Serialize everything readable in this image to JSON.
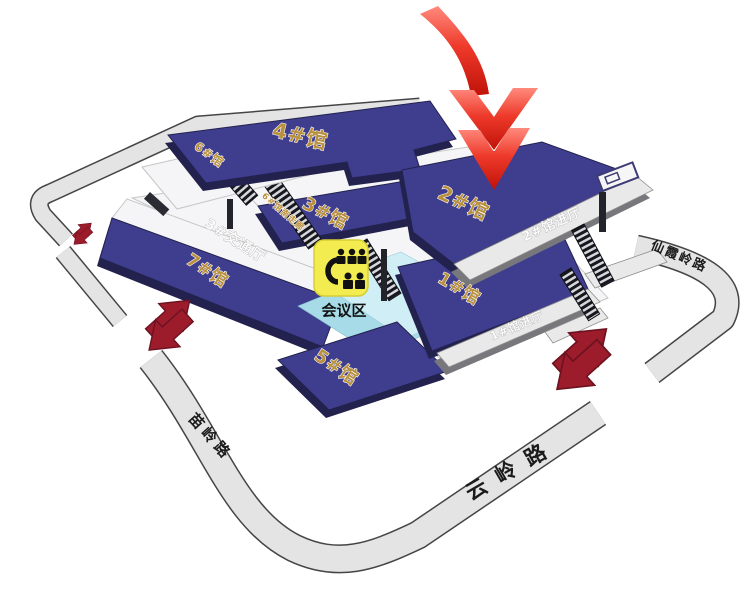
{
  "map": {
    "halls": {
      "h1": "1#馆",
      "h2": "2#馆",
      "h3": "3#馆",
      "h4": "4#馆",
      "h5": "5#馆",
      "h6": "6#馆",
      "h7": "7#馆"
    },
    "areas": {
      "traffic_hall": "3#交通厅",
      "hall6_south_corridor": "6#馆南走廊",
      "hall2_entrance": "2#馆进厅",
      "hall1_entrance": "1#馆进厅",
      "conference_area": "会议区"
    },
    "roads": {
      "miaoling": "苗岭路",
      "yunling": "云岭路",
      "xianxialing": "仙霞岭路"
    },
    "icons": {
      "conference": "meeting-people-icon",
      "main_pointer": "big-red-down-arrow",
      "gates": "two-way-entrance-arrows"
    },
    "colors": {
      "hall_navy": "#3f3d8e",
      "hall_navy_dark": "#23224e",
      "floor_white": "#f5f5f7",
      "strip_gray": "#e9e9e9",
      "road_gray": "#e4e4e4",
      "road_edge": "#454545",
      "conference_cyan": "#cfeef5",
      "conference_cyan_deep": "#a6dbe7",
      "label_gold": "#b8903e",
      "pointer_red": "#e83323",
      "gate_arrow_red": "#9c1c2b",
      "icon_yellow": "#f3ec50"
    }
  }
}
